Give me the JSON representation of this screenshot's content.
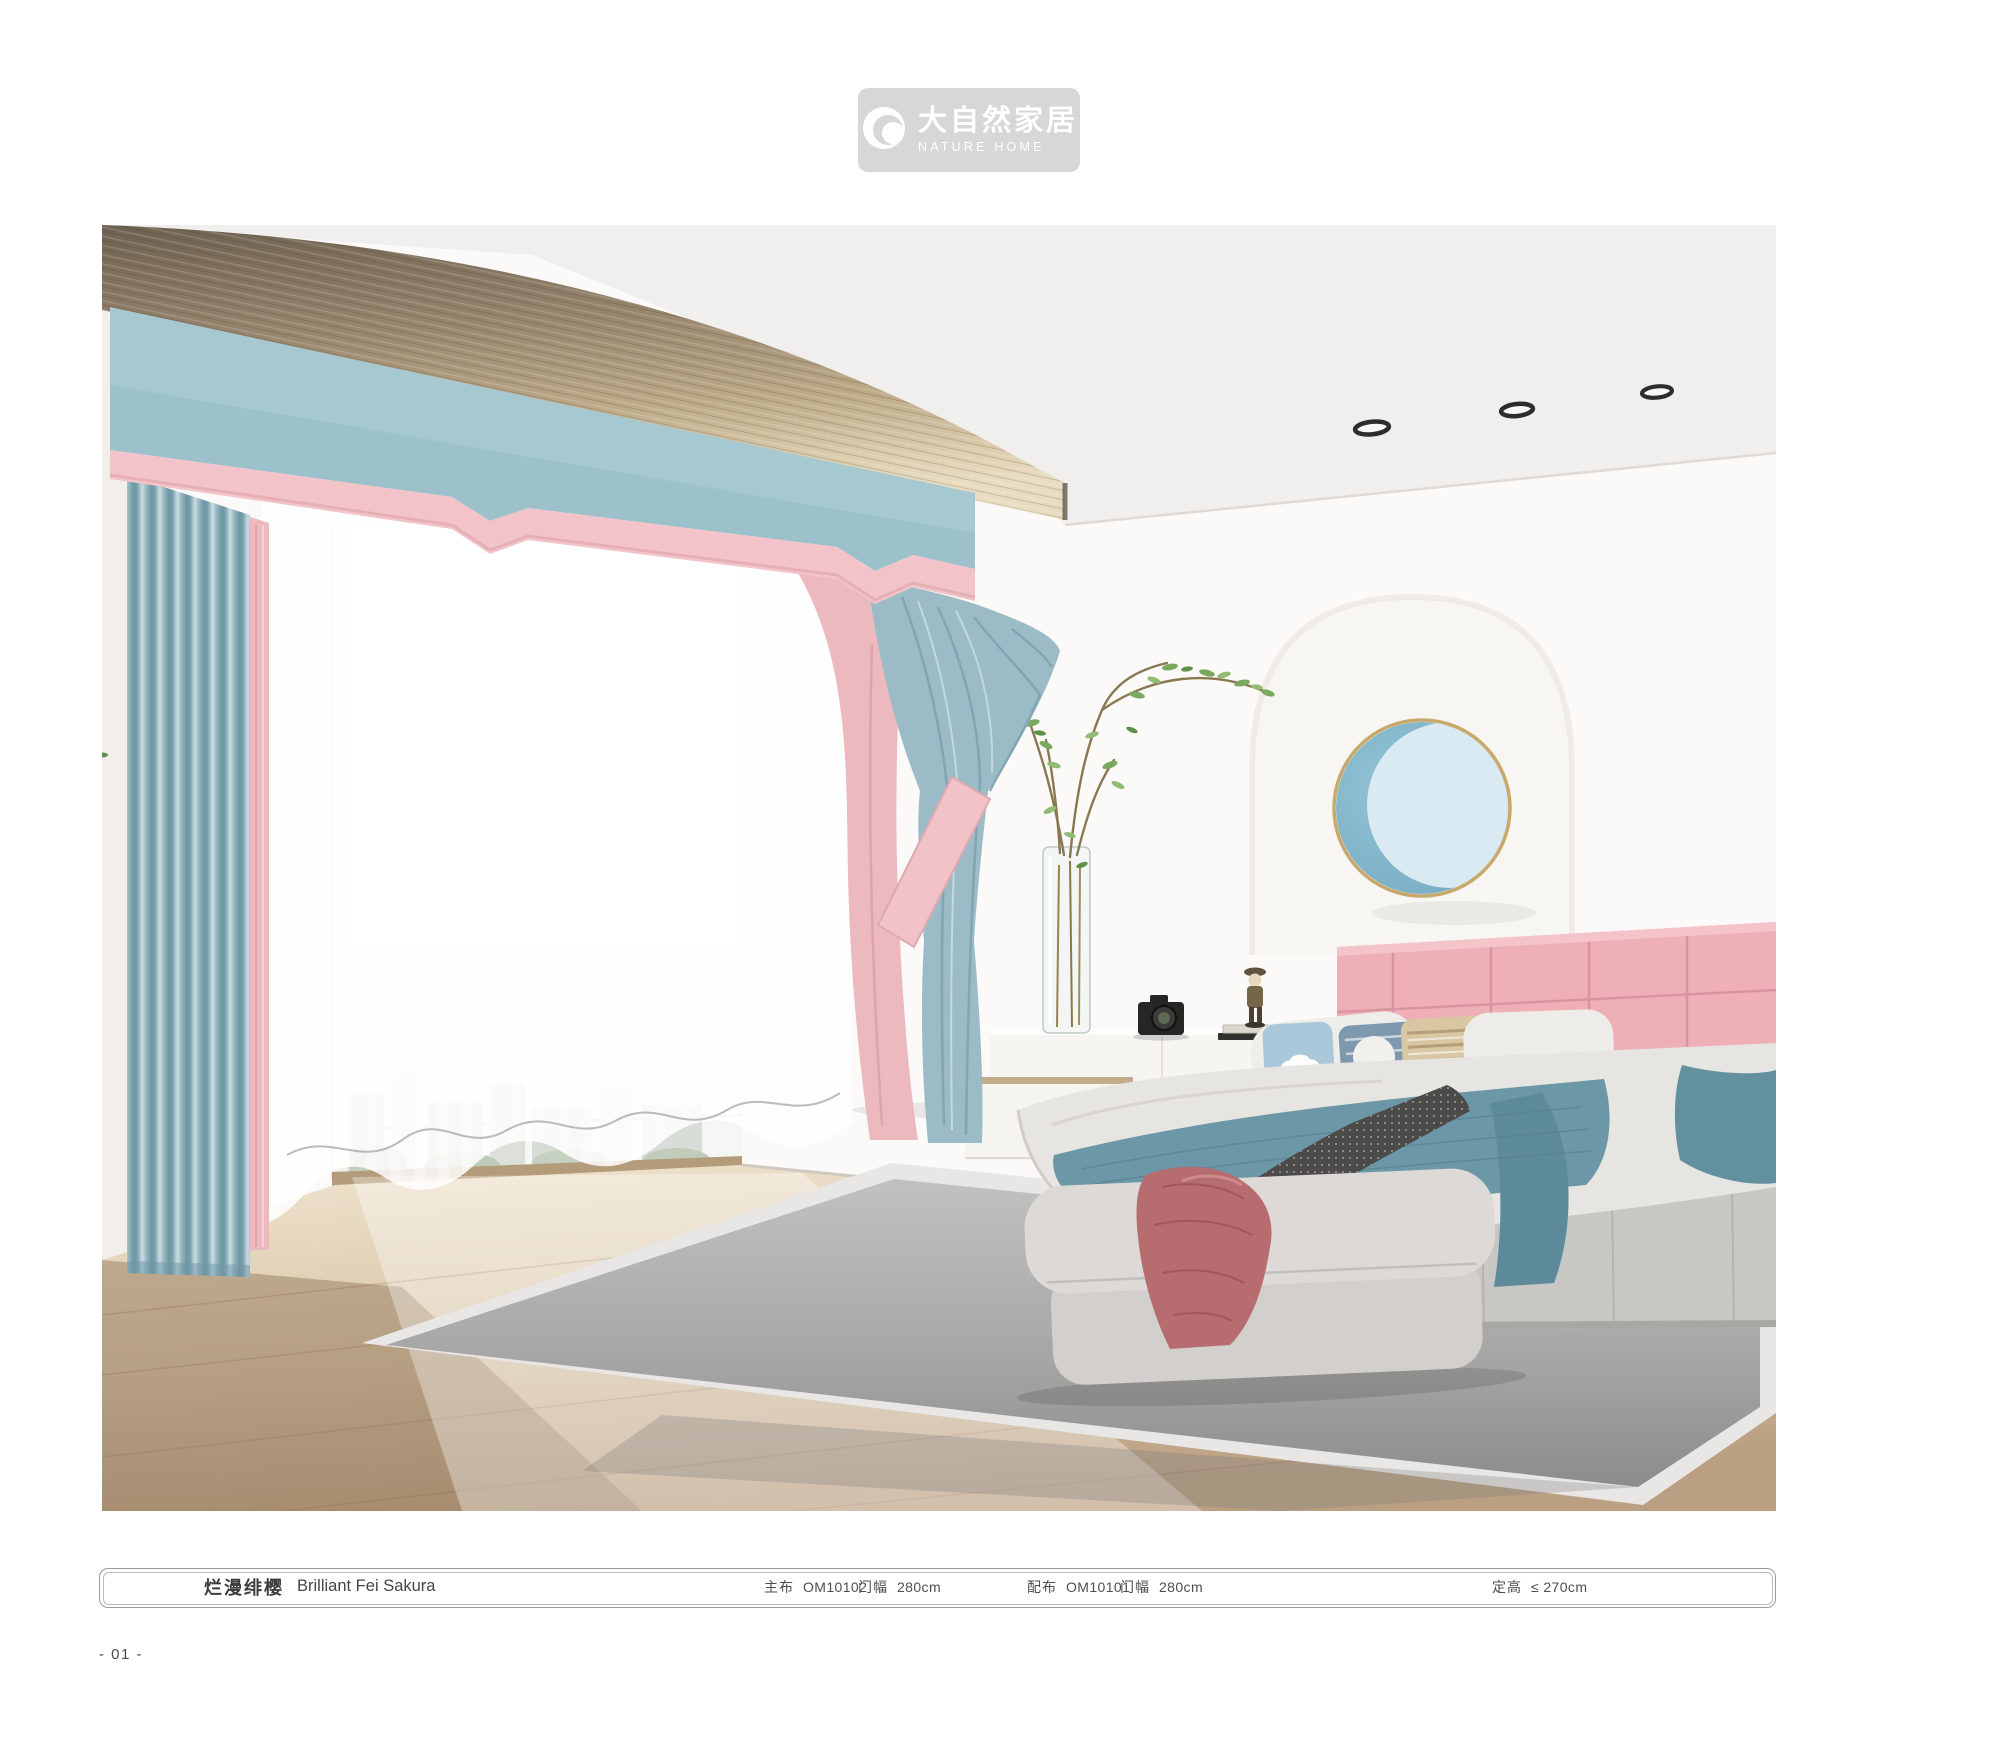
{
  "brand": {
    "name_cn": "大自然家居",
    "name_en": "NATURE HOME"
  },
  "product": {
    "title_cn": "烂漫绯樱",
    "title_en": "Brilliant Fei Sakura",
    "specs": [
      {
        "label": "主布",
        "value": "OM10102"
      },
      {
        "label": "门幅",
        "value": "280cm"
      },
      {
        "label": "配布",
        "value": "OM10101"
      },
      {
        "label": "门幅",
        "value": "280cm"
      },
      {
        "label": "定高",
        "value": "≤ 270cm"
      }
    ]
  },
  "page": {
    "number": "- 01 -"
  },
  "scene": {
    "description": "bedroom render with blue curtains, pink trim valance, sheer curtains, pink tufted headboard bed, bench and grey rug",
    "icons": [
      "ceiling-spotlight-icon",
      "moon-wall-decor"
    ]
  },
  "colors": {
    "badge_gray": "#d8d7d5",
    "valance_blue": "#a6c8d1",
    "trim_pink": "#f2c4c9",
    "curtain_blue": "#8fb3bd",
    "headboard_pink": "#eeafb7",
    "teal_blanket": "#6b97a6",
    "rose_blanket": "#b76c70",
    "wood_beam": "#a89478",
    "floor_wood": "#d8c8ae",
    "rug_gray": "#aeaeac",
    "moon_blue": "#82b7cb",
    "moon_light": "#d9eaf3",
    "wall_white": "#fbfaf8"
  }
}
